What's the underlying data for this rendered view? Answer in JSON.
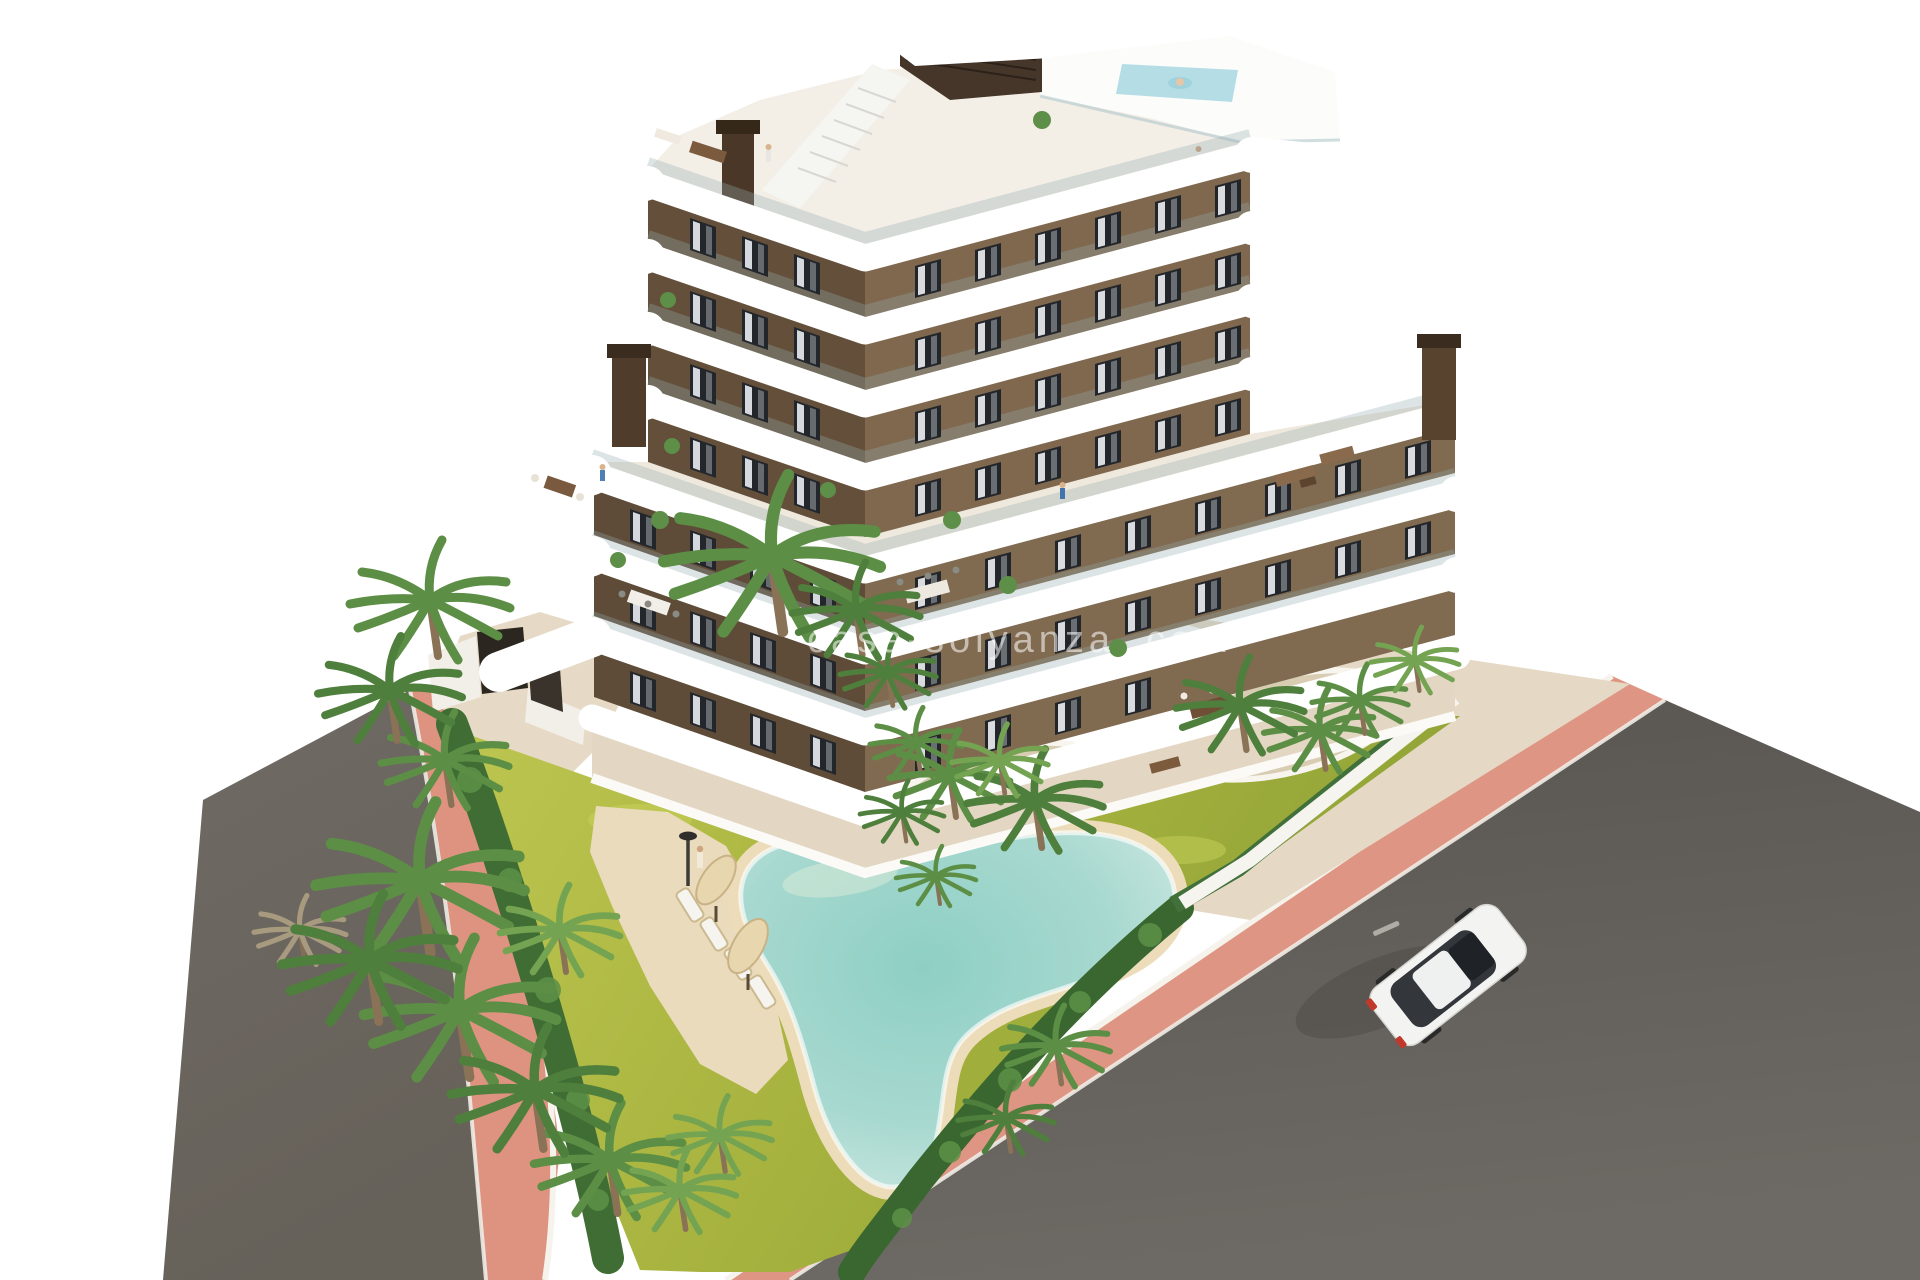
{
  "scene": {
    "type": "architectural-aerial-render",
    "watermark": "casa-solyanza .com",
    "elements": {
      "building": "apartment building with tiered white balcony bands",
      "rooftop": "rooftop terraces with plunge pool and stair access",
      "garden": "landscaped lawn with palm planter islands",
      "pool": "free-form swimming pool with sand beach edge",
      "loungers": "sun loungers with cream parasols",
      "streets": "asphalt roads with pink paved sidewalks",
      "vehicle": "white car driving on the road"
    }
  },
  "colors": {
    "background": "#ffffff",
    "wall_brown_dark": "#64503a",
    "wall_brown_light": "#7f684e",
    "balcony_white": "#ffffff",
    "grass": "#a9b640",
    "pool_water": "#9fd2c8",
    "pool_sand": "#ecdcba",
    "sidewalk_pink": "#df9583",
    "road_gray": "#615d59",
    "pavement_tan": "#e5d9c5",
    "hedge_green": "#3f6d33",
    "palm_green": "#5c8f45",
    "car_white": "#f3f3f2"
  }
}
